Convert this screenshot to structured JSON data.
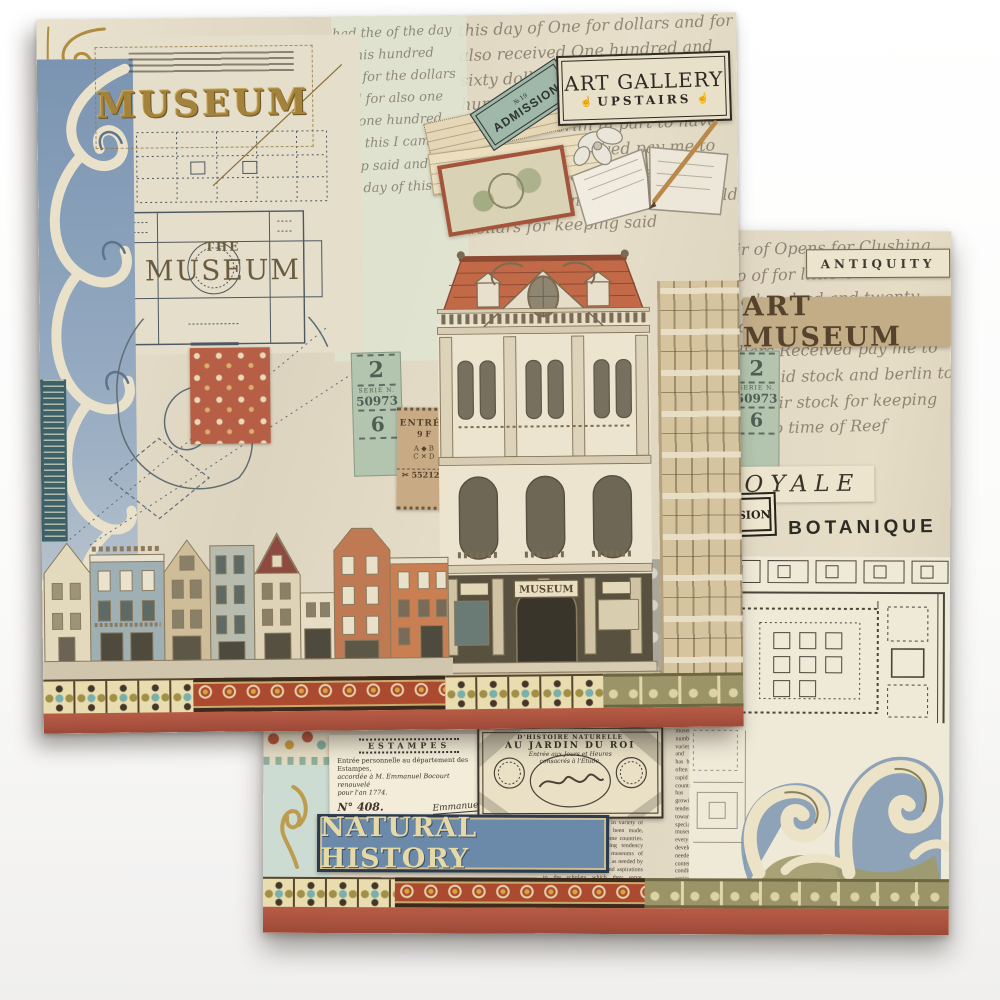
{
  "colors": {
    "terracotta": "#ad5742",
    "gold": "#a3823c",
    "blue_damask": "#7b94b1",
    "paper": "#e5ddc9",
    "banner_blue": "#6b89a8",
    "banner_text": "#e6d9a8",
    "ticket_green": "#b3c5ae",
    "tan": "#c2ad87"
  },
  "sheet1": {
    "museum_title": "MUSEUM",
    "the_museum": {
      "the": "THE",
      "museum": "MUSEUM"
    },
    "art_gallery": {
      "line1": "ART GALLERY",
      "line2": "UPSTAIRS",
      "icon": "☝"
    },
    "admission_ticket": {
      "no": "№ 19",
      "word": "ADMISSION"
    },
    "ticket_strip": {
      "n1": "2",
      "serie": "SERIE N.",
      "num": "50973",
      "n2": "6"
    },
    "entree_stamp": {
      "title": "ENTRÉE",
      "price": "9 F",
      "row1": "A ◆ B",
      "row2": "C ✕ D",
      "code": "✂ 55212A"
    },
    "building_sign": "MUSEUM",
    "script_text": "this day of One for dollars and for also received One hundred and sixty dollars and for three hundred, I came to keep said stock and berlin in part to have fair dollars Received pay me to keep said stock for one hundred and twenty and how another gold dollars for keeping said",
    "script_text2": "had the of the day of this hundred and for the dollars said for also one for one hundred and this I came to keep said and for the day of this for"
  },
  "sheet2": {
    "antiquity": "ANTIQUITY",
    "art_museum": "ART MUSEUM",
    "royale": "ROYALE",
    "sion": "SION",
    "botanique": "BOTANIQUE",
    "ticket_strip": {
      "n1": "2",
      "serie": "SERIE N.",
      "num": "50973",
      "n2": "6"
    },
    "script_text": "hair of Opens for Clushing two of for little One herd One hundred and twenty two how another gold dollars Received pay me to keep said stock and berlin to have fair stock for keeping such no time of Reef",
    "estampes_doc": {
      "title": "ESTAMPES",
      "line1": "Entrée personnelle au département des Estampes,",
      "line2": "accordée à M. Emmanuel Bocourt renouvelé",
      "line3": "pour l'an 1774.",
      "number": "N° 408.",
      "sig": "Emmanuel"
    },
    "jardin_card": {
      "line0": "D'HISTOIRE NATURELLE",
      "line1": "AU JARDIN DU ROI",
      "line2": "Entrée aux Jours et Heures",
      "line3": "consacrés à l'Étude."
    },
    "natural_history": "NATURAL HISTORY",
    "news_text": "museums in numbers and in variety of forms and functions has been made, often currently rapid in some countries. There has been a growing tendency towards specialisms and museums of every kind have developed, as needed by contemporary conditions and aspirations to the scholars which they serve. Meanwhile improvements people have increasingly come to visit and enjoy their museums with"
  }
}
